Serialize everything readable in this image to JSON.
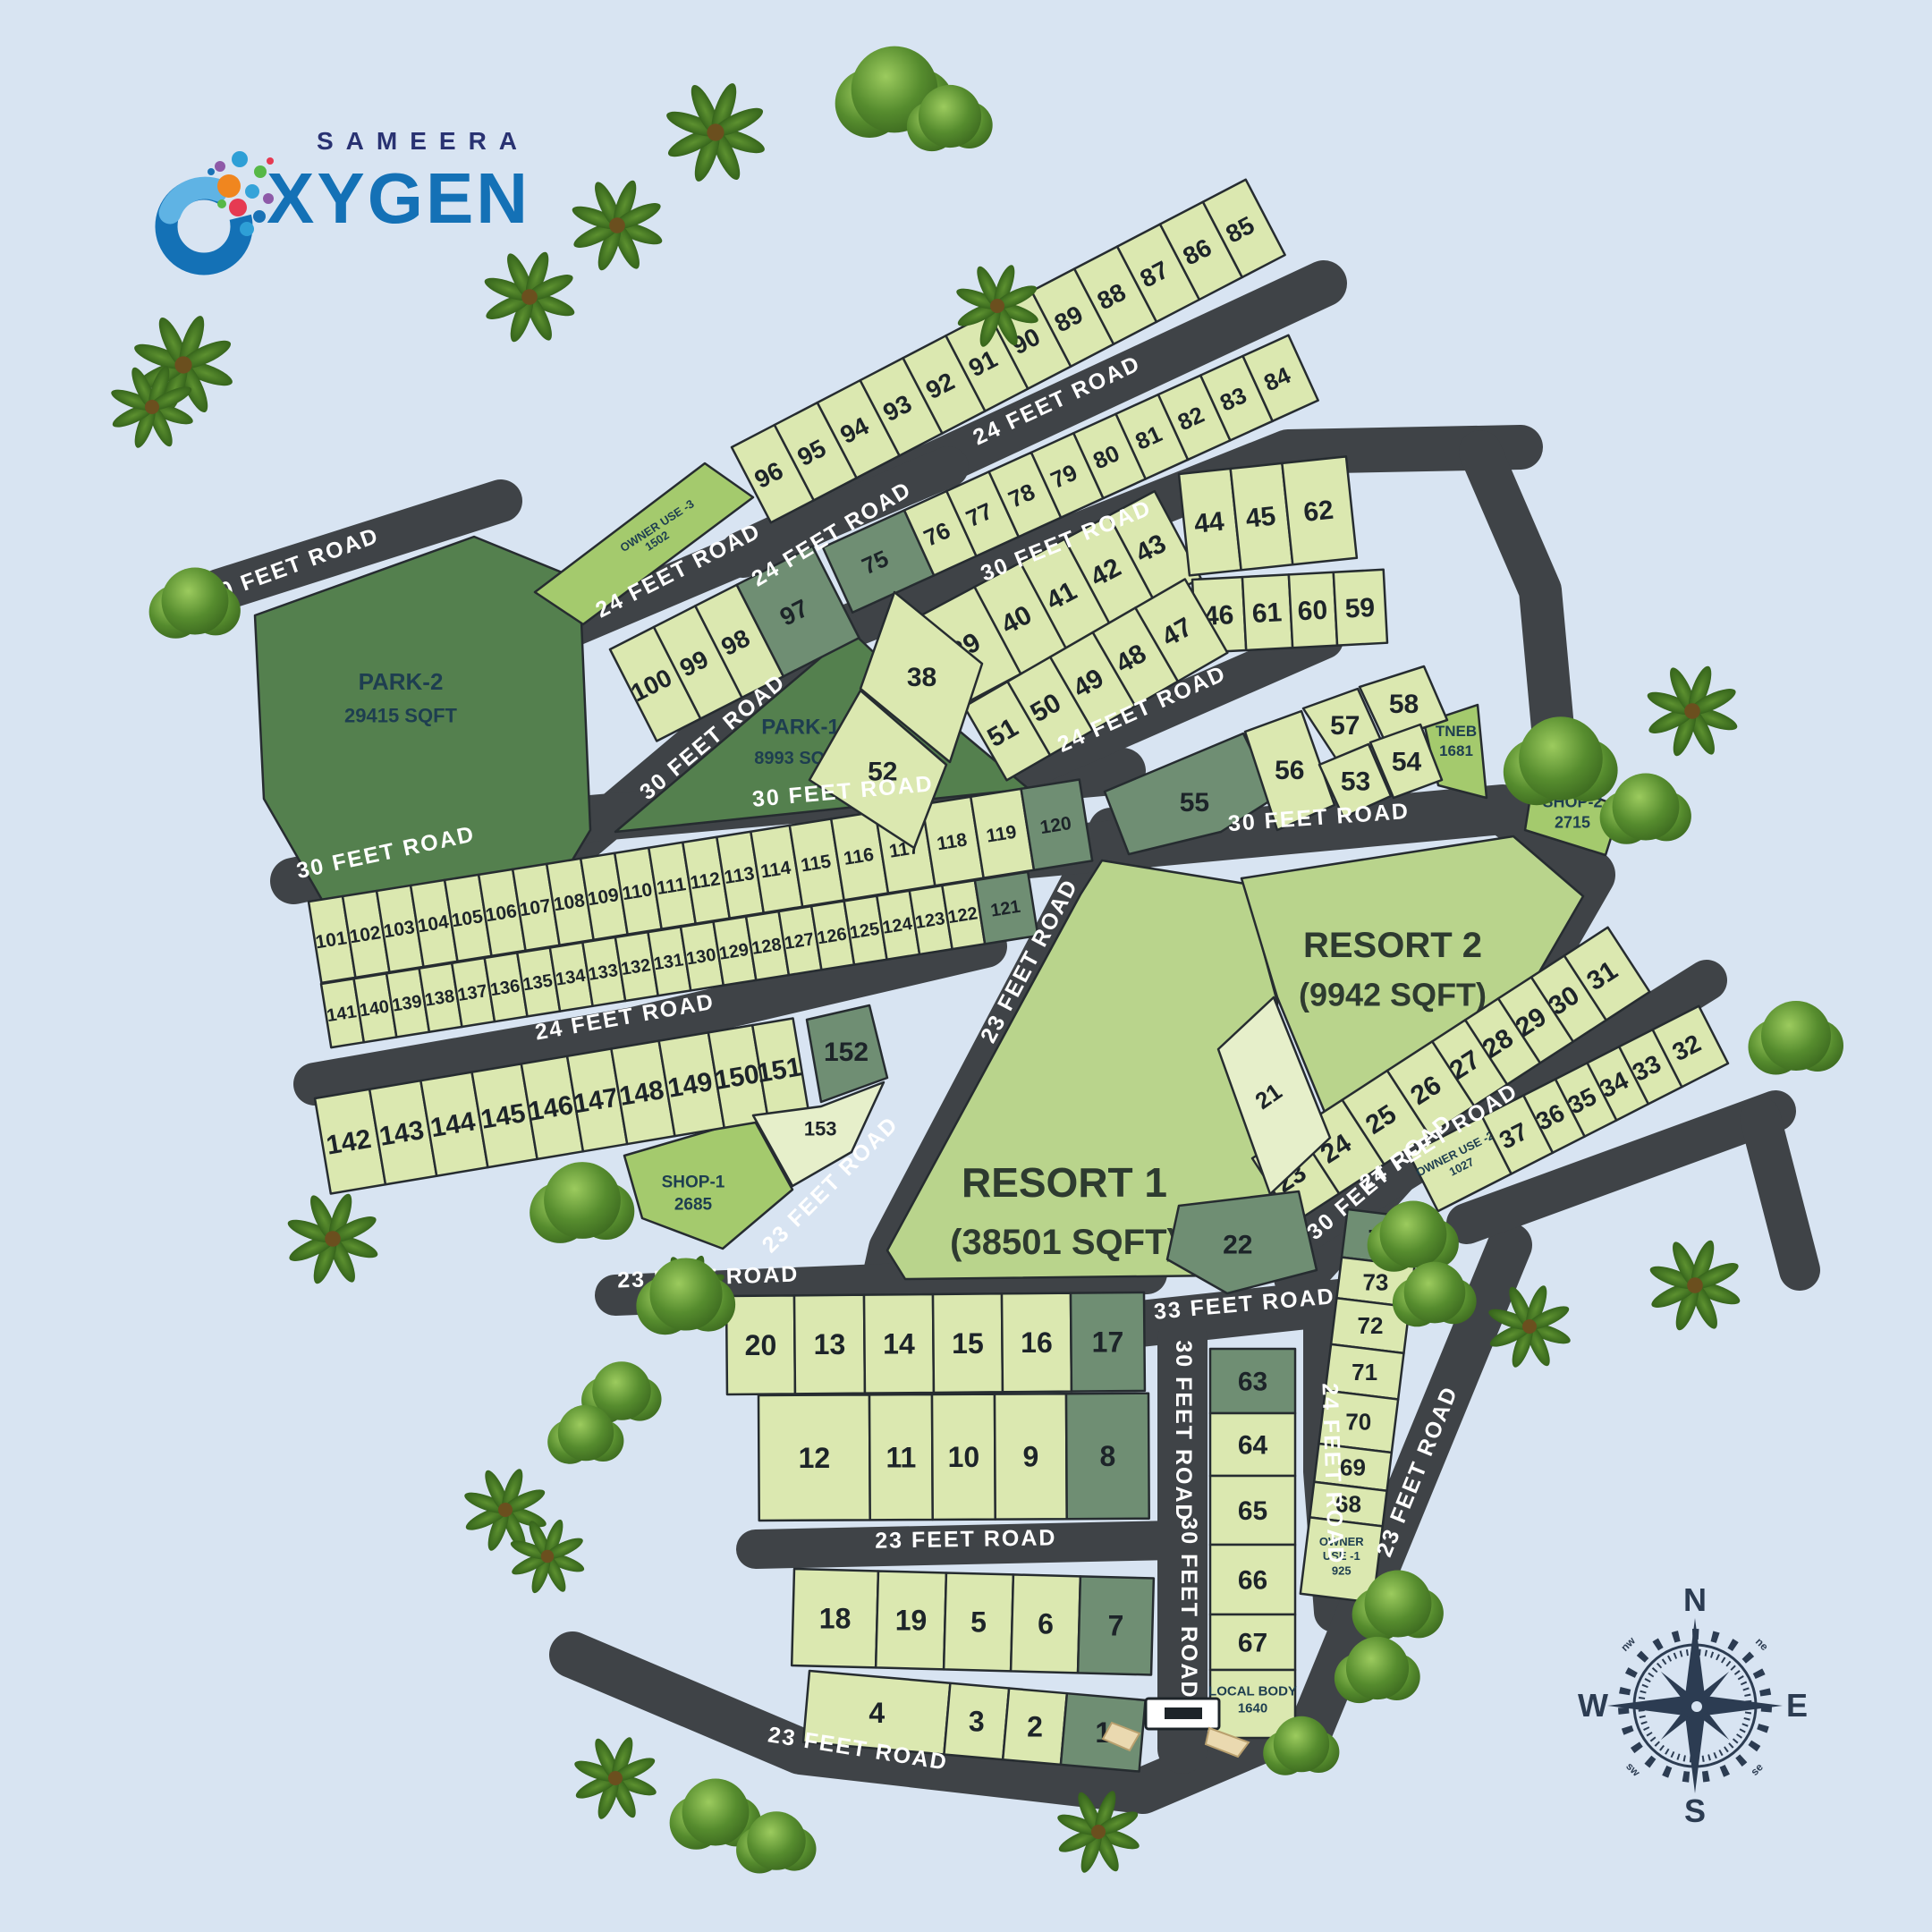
{
  "logo": {
    "brand": "SAMEERA",
    "product_o": "O",
    "product_rest": "XYGEN"
  },
  "road_labels": [
    "24 FEET ROAD",
    "30 FEET ROAD",
    "30 FEET ROAD",
    "24 FEET ROAD",
    "24 FEET ROAD",
    "30 FEET ROAD",
    "30 FEET ROAD",
    "30 FEET ROAD",
    "24 FEET ROAD",
    "30 FEET ROAD",
    "24 FEET ROAD",
    "23 FEET ROAD",
    "23 FEET ROAD",
    "30 FEET ROAD",
    "24 FEET ROAD",
    "23 FEET ROAD",
    "23 FEET ROAD",
    "23 FEET ROAD",
    "33 FEET ROAD",
    "30 FEET ROAD",
    "30 FEET ROAD",
    "24 FEET ROAD",
    "23 FEET ROAD"
  ],
  "plots": {
    "numbers": [
      "1",
      "2",
      "3",
      "4",
      "5",
      "6",
      "7",
      "8",
      "9",
      "10",
      "11",
      "12",
      "13",
      "14",
      "15",
      "16",
      "17",
      "18",
      "19",
      "20",
      "21",
      "22",
      "23",
      "24",
      "25",
      "26",
      "27",
      "28",
      "29",
      "30",
      "31",
      "32",
      "33",
      "34",
      "35",
      "36",
      "37",
      "38",
      "39",
      "40",
      "41",
      "42",
      "43",
      "44",
      "45",
      "46",
      "47",
      "48",
      "49",
      "50",
      "51",
      "52",
      "53",
      "54",
      "55",
      "56",
      "57",
      "58",
      "59",
      "60",
      "61",
      "62",
      "63",
      "64",
      "65",
      "66",
      "67",
      "68",
      "69",
      "70",
      "71",
      "72",
      "73",
      "74",
      "75",
      "76",
      "77",
      "78",
      "79",
      "80",
      "81",
      "82",
      "83",
      "84",
      "85",
      "86",
      "87",
      "88",
      "89",
      "90",
      "91",
      "92",
      "93",
      "94",
      "95",
      "96",
      "97",
      "98",
      "99",
      "100",
      "101",
      "102",
      "103",
      "104",
      "105",
      "106",
      "107",
      "108",
      "109",
      "110",
      "111",
      "112",
      "113",
      "114",
      "115",
      "116",
      "117",
      "118",
      "119",
      "120",
      "121",
      "122",
      "123",
      "124",
      "125",
      "126",
      "127",
      "128",
      "129",
      "130",
      "131",
      "132",
      "133",
      "134",
      "135",
      "136",
      "137",
      "138",
      "139",
      "140",
      "141",
      "142",
      "143",
      "144",
      "145",
      "146",
      "147",
      "148",
      "149",
      "150",
      "151",
      "152",
      "153"
    ]
  },
  "special_areas": [
    {
      "id": "park2",
      "lines": [
        "PARK-2",
        "29415 SQFT"
      ]
    },
    {
      "id": "park1",
      "lines": [
        "PARK-1",
        "8993 SQFT"
      ]
    },
    {
      "id": "resort1",
      "lines": [
        "RESORT 1",
        "(38501 SQFT)"
      ]
    },
    {
      "id": "resort2",
      "lines": [
        "RESORT 2",
        "(9942 SQFT)"
      ]
    },
    {
      "id": "shop1",
      "lines": [
        "SHOP-1",
        "2685"
      ]
    },
    {
      "id": "shop2",
      "lines": [
        "SHOP-2",
        "2715"
      ]
    },
    {
      "id": "tneb",
      "lines": [
        "TNEB",
        "1681"
      ]
    },
    {
      "id": "ou1",
      "lines": [
        "OWNER",
        "USE -1",
        "925"
      ]
    },
    {
      "id": "ou2",
      "lines": [
        "OWNER USE -2",
        "1027"
      ]
    },
    {
      "id": "ou3",
      "lines": [
        "OWNER USE -3",
        "1502"
      ]
    },
    {
      "id": "localbody",
      "lines": [
        "LOCAL BODY",
        "1640"
      ]
    }
  ],
  "compass": {
    "n": "N",
    "e": "E",
    "s": "S",
    "w": "W",
    "nw": "nw",
    "ne": "ne",
    "sw": "sw",
    "se": "se"
  },
  "colors": {
    "background": "#d8e4f2",
    "road": "#3f4347",
    "plot": "#dbe8b0",
    "plot_dark": "#6f8e73",
    "plot_pale": "#e6efca",
    "park": "#54804e",
    "resort": "#b9d48c",
    "amenity": "#a4ca6d",
    "outline": "#262c30",
    "road_text": "#ffffff",
    "number_text": "#1d2429",
    "special_text": "#1e3e50",
    "logo_navy": "#293272",
    "logo_blue": "#1471b6"
  }
}
